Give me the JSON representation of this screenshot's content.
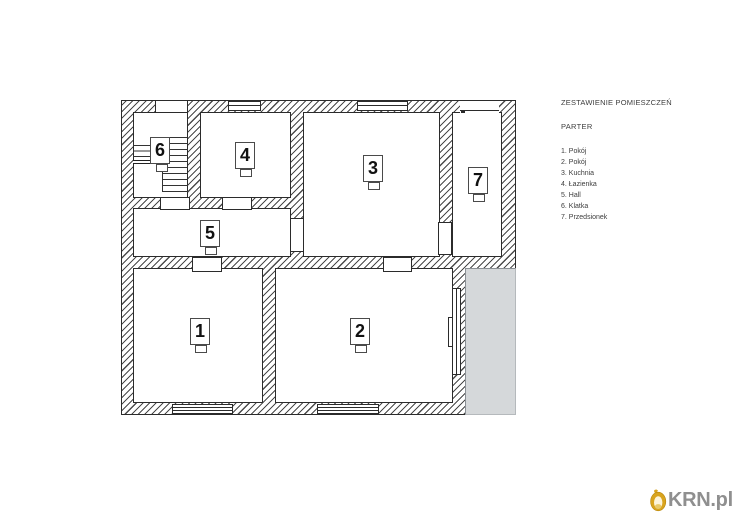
{
  "legend": {
    "title": "ZESTAWIENIE POMIESZCZEŃ",
    "floor": "PARTER",
    "items": [
      "1. Pokój",
      "2. Pokój",
      "3. Kuchnia",
      "4. Łazienka",
      "5. Hall",
      "6. Klatka",
      "7. Przedsionek"
    ]
  },
  "rooms": [
    {
      "number": "1"
    },
    {
      "number": "2"
    },
    {
      "number": "3"
    },
    {
      "number": "4"
    },
    {
      "number": "5"
    },
    {
      "number": "6"
    },
    {
      "number": "7"
    }
  ],
  "watermark": {
    "text": "KRN.pl"
  },
  "colors": {
    "accent_gold": "#d9a41e",
    "watermark_gray": "#8f8f8f",
    "terrace_fill": "#d5d8da",
    "line": "#2b2b2b"
  }
}
